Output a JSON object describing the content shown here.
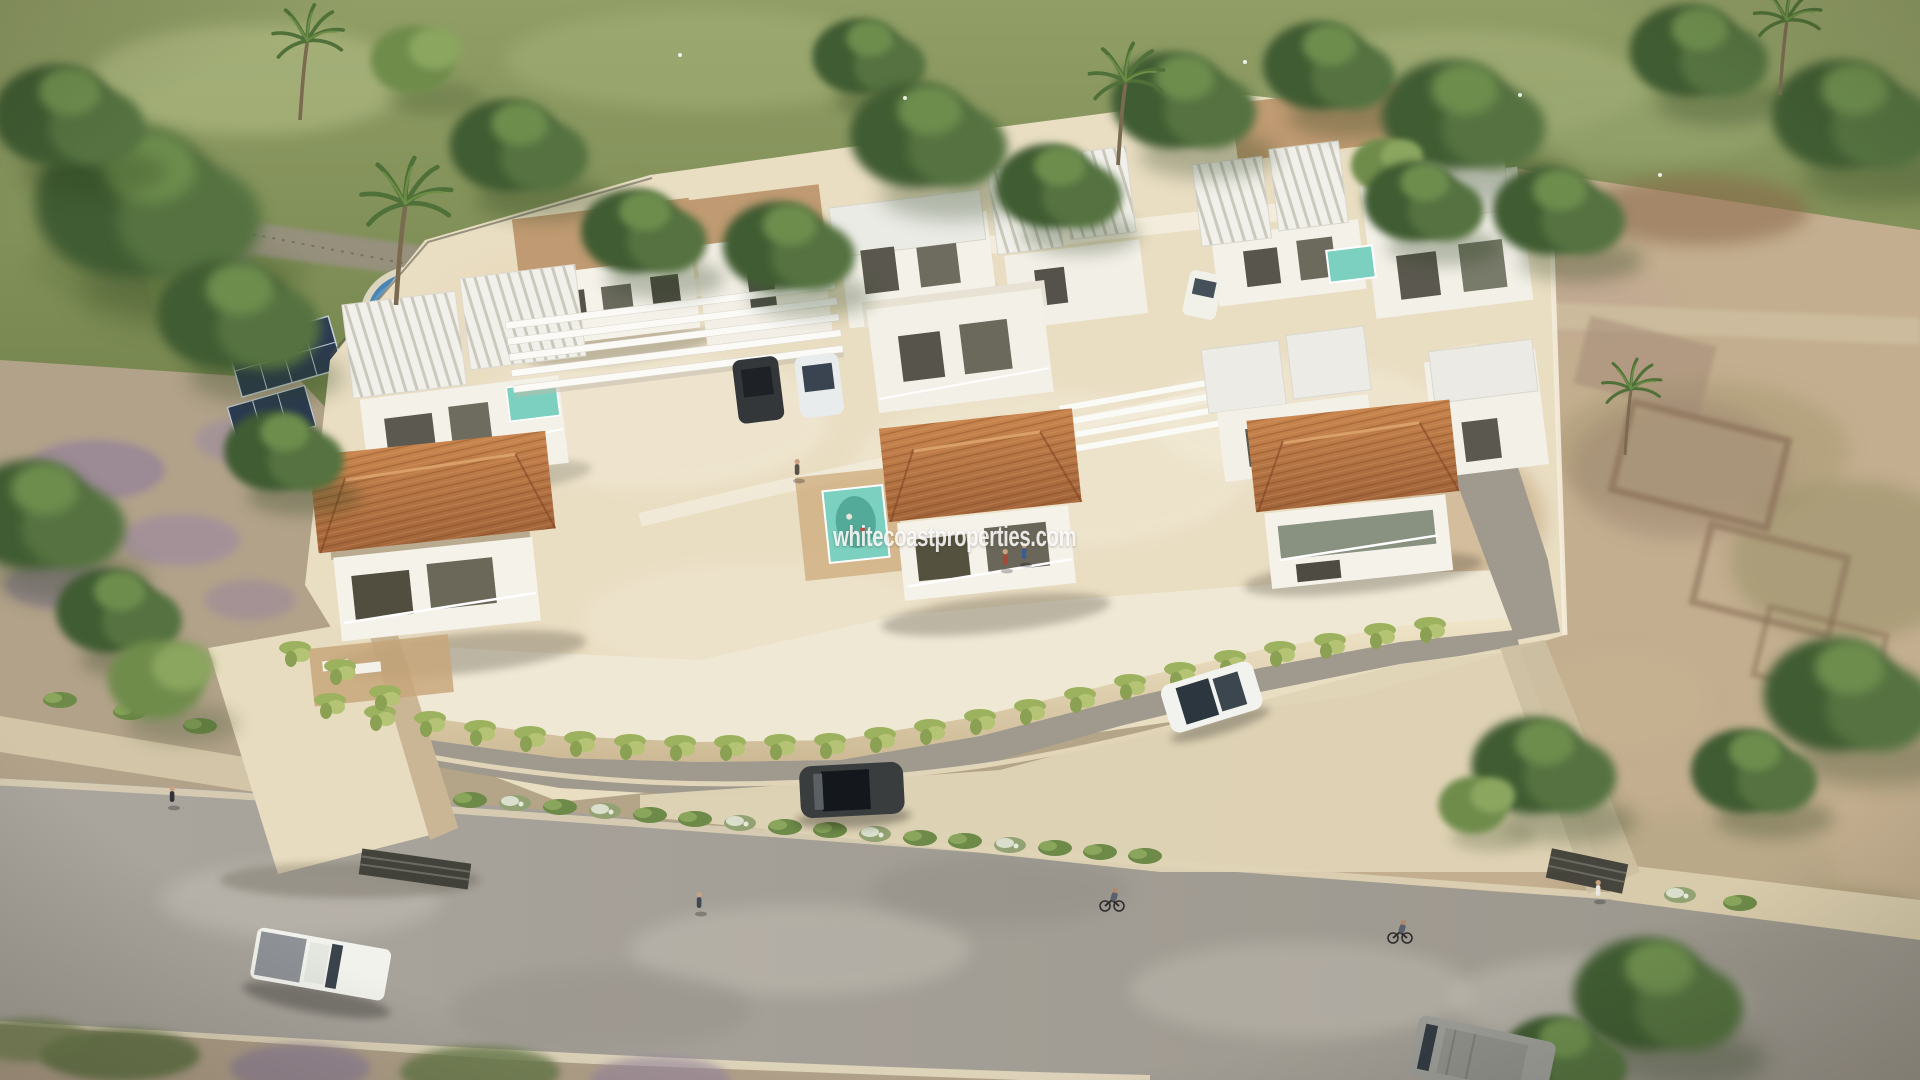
{
  "scene": {
    "type": "aerial-architectural-render",
    "subject": "Aerial 3D render of a gated development of modern white villas with terracotta hip roofs, flat tan roofs and white pergolas, elevated on a cream perimeter wall with hanging vines, an inner private street, surrounded by green meadow with trees and palms (top/left), dry scrubland with stone ruin foundations (right), a neighbouring plot with blue pool and solar panels (left), and a grey asphalt road in front",
    "watermark": "whitecoastproperties.com"
  },
  "palette": {
    "meadow_green": "#8e9b64",
    "tree_green_dark": "#3f5c31",
    "tree_green_light": "#6f8c4b",
    "scrubland_tan": "#c3ae8f",
    "estate_ground_cream": "#e9ddc2",
    "wall_cream": "#efe3c6",
    "villa_white": "#f4f1e9",
    "terracotta_roof": "#b4713e",
    "flat_roof_tan": "#bf9a72",
    "pergola_white": "#f2f1ec",
    "asphalt_grey": "#a8a39b",
    "inner_street_grey": "#a09a8e",
    "pool_turquoise": "#7bd0c0",
    "neighbour_pool_blue": "#4d86b4",
    "solar_panel_navy": "#2b3a52",
    "vine_green": "#9db25e"
  },
  "estate": {
    "front_villas": [
      {
        "name": "front-left-villa",
        "roof": "terracotta hip roof",
        "features": "balcony, wood deck with loungers"
      },
      {
        "name": "front-center-villa",
        "roof": "terracotta hip roof",
        "features": "balcony with two people, turquoise mural pool"
      },
      {
        "name": "front-right-villa",
        "roof": "terracotta hip roof",
        "features": "glass balcony"
      }
    ],
    "back_villas": "two rows of white two-storey villas with tan flat roofs and white ribbed slab roofs",
    "structures": [
      "white carport pergola",
      "white pergola walkways",
      "perimeter wall with hanging vines",
      "inner private street",
      "entrance gate",
      "basement garage door",
      "cypress hedgerow",
      "plunge pools"
    ]
  },
  "vehicles": [
    {
      "name": "white-pickup-truck",
      "location": "main road, lower left"
    },
    {
      "name": "grey-van",
      "location": "main road, bottom right"
    },
    {
      "name": "dark-grey-car",
      "location": "inner street, center"
    },
    {
      "name": "white-suv",
      "location": "inner street, right"
    },
    {
      "name": "parked-dark-suv",
      "location": "carport"
    },
    {
      "name": "parked-white-car",
      "location": "carport"
    },
    {
      "name": "parked-white-car-upper",
      "location": "upper-right villa drive"
    }
  ],
  "people": [
    {
      "name": "pedestrian-left-sidewalk"
    },
    {
      "name": "pedestrian-on-road-center"
    },
    {
      "name": "pedestrian-near-gate"
    },
    {
      "name": "cyclist-center"
    },
    {
      "name": "cyclist-right"
    },
    {
      "name": "walker-inside-estate"
    },
    {
      "name": "two-people-on-center-balcony"
    }
  ],
  "surroundings": [
    "green meadow with tree row (top)",
    "palm trees",
    "diagonal path with fence (top left)",
    "gravel path (top right)",
    "dry scrubland (right)",
    "stone ruin foundations (right)",
    "neighbour plot with blue pool, lawn and solar panels (left)",
    "purple flowering shrubs (left and bottom)",
    "hedge strip with white-flowering bushes along road"
  ]
}
